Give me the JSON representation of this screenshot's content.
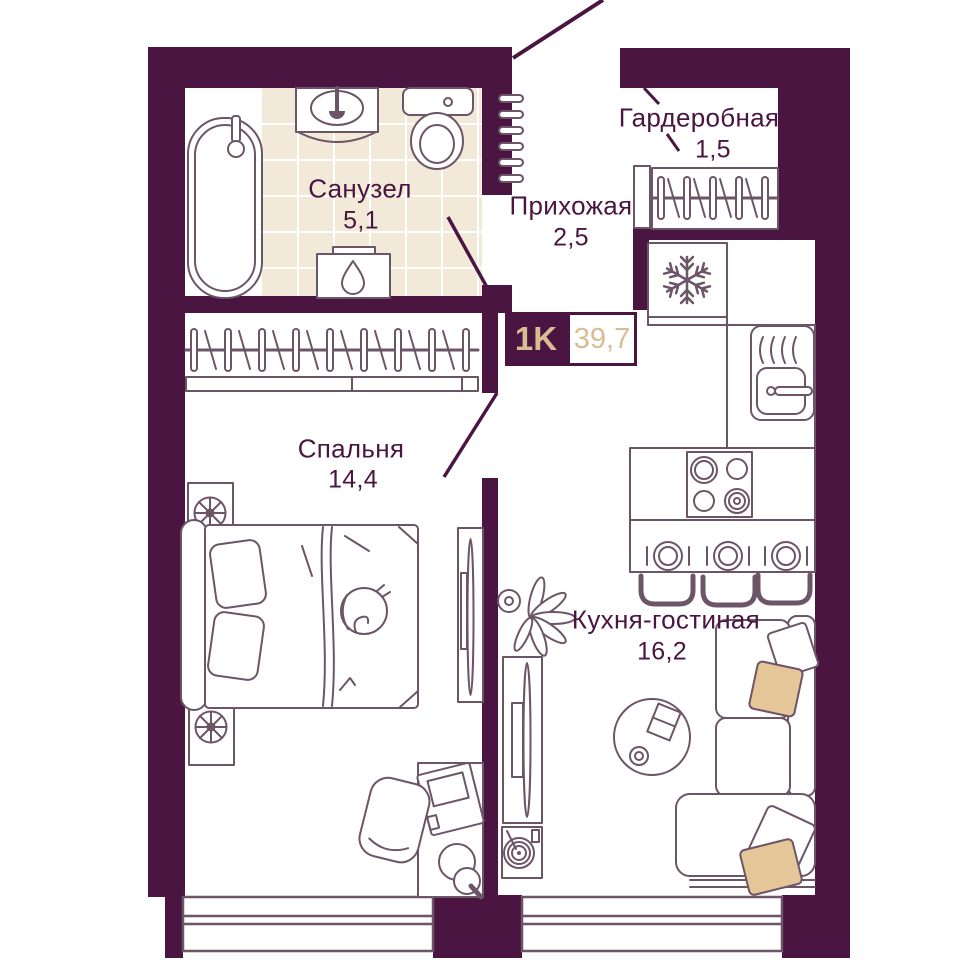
{
  "plan": {
    "type_badge": {
      "label": "1K",
      "total_area": "39,7"
    },
    "rooms": [
      {
        "id": "bathroom",
        "name": "Санузел",
        "area": "5,1"
      },
      {
        "id": "hallway",
        "name": "Прихожая",
        "area": "2,5"
      },
      {
        "id": "wardrobe",
        "name": "Гардеробная",
        "area": "1,5"
      },
      {
        "id": "bedroom",
        "name": "Спальня",
        "area": "14,4"
      },
      {
        "id": "kitchen_living",
        "name": "Кухня-гостиная",
        "area": "16,2"
      }
    ],
    "colors": {
      "wall": "#4a1540",
      "furniture_line": "#6d5568",
      "tile_floor": "#f2e9d8",
      "accent_text": "#d9bc92",
      "pillow_accent": "#e4c698"
    },
    "icons": {
      "fridge": "snowflake-icon",
      "water_heater": "water-drop-icon",
      "nightstand_decor": "fan-icon",
      "bed_decor": "cat-icon",
      "living_decor": "plant-icon"
    }
  }
}
